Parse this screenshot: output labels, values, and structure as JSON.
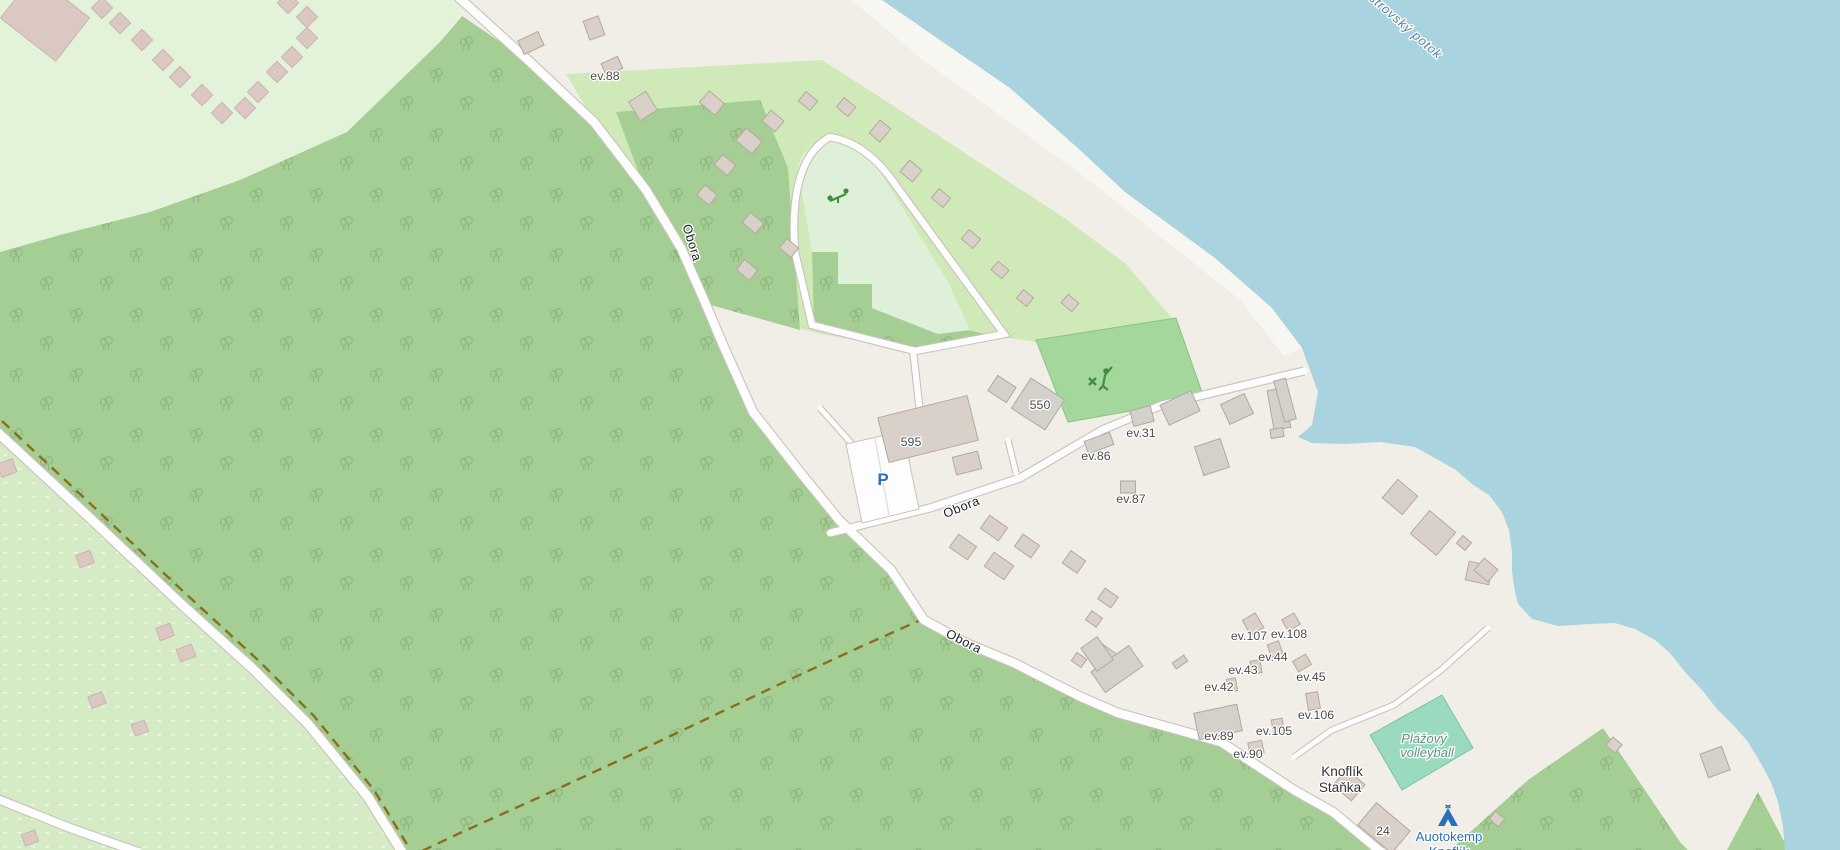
{
  "map": {
    "colors": {
      "base_land": "#f1eee8",
      "sand_bright": "#f8f6f0",
      "water": "#a9d3df",
      "forest": "#a5ce94",
      "scrub": "#e3f3da",
      "orchard": "#d5ebc5",
      "camp_site": "#cfeab8",
      "meadow": "#def1d8",
      "golf_pitch": "#a4d79b",
      "volleyball_pitch": "#9adbc0",
      "building_tan": "#d9d0c9",
      "building_gray": "#d4d0ca",
      "building_pink": "#dcc8c3",
      "road_fill": "#fdfdfd",
      "road_casing": "#c9c3ba",
      "track_dash": "#8c6d1c",
      "icon_green": "#3d8e3d",
      "icon_blue": "#2a6fba"
    },
    "labels": [
      {
        "text": "ev.88",
        "x": 605,
        "y": 80,
        "r": 0,
        "cls": "hn",
        "name": "house-number-ev88"
      },
      {
        "text": "595",
        "x": 911,
        "y": 446,
        "r": 0,
        "cls": "hn",
        "name": "house-number-595"
      },
      {
        "text": "550",
        "x": 1040,
        "y": 409,
        "r": 0,
        "cls": "hn",
        "name": "house-number-550"
      },
      {
        "text": "ev.31",
        "x": 1141,
        "y": 437,
        "r": 0,
        "cls": "hn",
        "name": "house-number-ev31"
      },
      {
        "text": "ev.86",
        "x": 1096,
        "y": 460,
        "r": 0,
        "cls": "hn",
        "name": "house-number-ev86"
      },
      {
        "text": "ev.87",
        "x": 1131,
        "y": 503,
        "r": 0,
        "cls": "hn",
        "name": "house-number-ev87"
      },
      {
        "text": "ev.107",
        "x": 1249,
        "y": 640,
        "r": 0,
        "cls": "hn",
        "name": "house-number-ev107"
      },
      {
        "text": "ev.108",
        "x": 1289,
        "y": 638,
        "r": 0,
        "cls": "hn",
        "name": "house-number-ev108"
      },
      {
        "text": "ev.44",
        "x": 1273,
        "y": 661,
        "r": 0,
        "cls": "hn",
        "name": "house-number-ev44"
      },
      {
        "text": "ev.43",
        "x": 1243,
        "y": 674,
        "r": 0,
        "cls": "hn",
        "name": "house-number-ev43"
      },
      {
        "text": "ev.42",
        "x": 1219,
        "y": 691,
        "r": 0,
        "cls": "hn",
        "name": "house-number-ev42"
      },
      {
        "text": "ev.45",
        "x": 1311,
        "y": 681,
        "r": 0,
        "cls": "hn",
        "name": "house-number-ev45"
      },
      {
        "text": "ev.106",
        "x": 1316,
        "y": 719,
        "r": 0,
        "cls": "hn",
        "name": "house-number-ev106"
      },
      {
        "text": "ev.105",
        "x": 1274,
        "y": 735,
        "r": 0,
        "cls": "hn",
        "name": "house-number-ev105"
      },
      {
        "text": "ev.89",
        "x": 1219,
        "y": 740,
        "r": 0,
        "cls": "hn",
        "name": "house-number-ev89"
      },
      {
        "text": "ev.90",
        "x": 1248,
        "y": 758,
        "r": 0,
        "cls": "hn",
        "name": "house-number-ev90"
      },
      {
        "text": "24",
        "x": 1383,
        "y": 835,
        "r": 0,
        "cls": "hn",
        "name": "house-number-24"
      },
      {
        "text": "Knoflík",
        "x": 1342,
        "y": 776,
        "r": 0,
        "cls": "nm",
        "name": "place-label-knoflik"
      },
      {
        "text": "Staňka",
        "x": 1340,
        "y": 792,
        "r": 0,
        "cls": "nm",
        "name": "place-label-stanka"
      },
      {
        "text": "Plážový",
        "x": 1424,
        "y": 743,
        "r": 0,
        "cls": "pitchlbl",
        "name": "pitch-label-line1"
      },
      {
        "text": "volleyball",
        "x": 1427,
        "y": 757,
        "r": 0,
        "cls": "pitchlbl",
        "name": "pitch-label-line2"
      },
      {
        "text": "Auotokemp",
        "x": 1449,
        "y": 841,
        "r": 0,
        "cls": "camp",
        "name": "campsite-label-line1"
      },
      {
        "text": "Knoflík",
        "x": 1449,
        "y": 856,
        "r": 0,
        "cls": "camp",
        "name": "campsite-label-line2"
      },
      {
        "text": "Obora",
        "x": 688,
        "y": 244,
        "r": 73,
        "cls": "street",
        "name": "street-label-obora-1"
      },
      {
        "text": "Obora",
        "x": 963,
        "y": 511,
        "r": -22,
        "cls": "street",
        "name": "street-label-obora-2"
      },
      {
        "text": "Obora",
        "x": 962,
        "y": 645,
        "r": 27,
        "cls": "street",
        "name": "street-label-obora-3"
      },
      {
        "text": "Ostrovský potok",
        "x": 1399,
        "y": 26,
        "r": 41,
        "cls": "wt",
        "name": "stream-label-ostrovsky-potok"
      },
      {
        "text": "P",
        "x": 883,
        "y": 485,
        "r": 0,
        "cls": "pk",
        "name": "parking-icon"
      }
    ],
    "icons": [
      {
        "kind": "playground",
        "x": 838,
        "y": 197,
        "name": "playground-icon"
      },
      {
        "kind": "golf",
        "x": 1100,
        "y": 380,
        "name": "golf-course-icon"
      },
      {
        "kind": "tent",
        "x": 1448,
        "y": 817,
        "name": "campsite-tent-icon"
      }
    ],
    "buildings": [
      [
        102,
        8,
        15,
        15,
        45,
        "p"
      ],
      [
        120,
        23,
        15,
        15,
        45,
        "p"
      ],
      [
        142,
        40,
        15,
        15,
        45,
        "p"
      ],
      [
        163,
        60,
        15,
        15,
        45,
        "p"
      ],
      [
        180,
        77,
        15,
        15,
        45,
        "p"
      ],
      [
        202,
        95,
        15,
        15,
        45,
        "p"
      ],
      [
        222,
        113,
        15,
        15,
        45,
        "p"
      ],
      [
        245,
        108,
        15,
        15,
        45,
        "p"
      ],
      [
        258,
        92,
        15,
        15,
        45,
        "p"
      ],
      [
        277,
        72,
        15,
        15,
        45,
        "p"
      ],
      [
        292,
        57,
        15,
        15,
        45,
        "p"
      ],
      [
        307,
        38,
        15,
        15,
        45,
        "p"
      ],
      [
        307,
        17,
        15,
        15,
        45,
        "p"
      ],
      [
        288,
        3,
        15,
        15,
        45,
        "p"
      ],
      [
        45,
        18,
        70,
        55,
        38,
        "p"
      ],
      [
        594,
        28,
        16,
        20,
        -20,
        "t"
      ],
      [
        531,
        43,
        22,
        15,
        -25,
        "t"
      ],
      [
        612,
        66,
        18,
        13,
        -25,
        "t"
      ],
      [
        643,
        106,
        20,
        22,
        -32,
        "t"
      ],
      [
        712,
        103,
        20,
        15,
        40,
        "t"
      ],
      [
        749,
        141,
        21,
        16,
        40,
        "t"
      ],
      [
        773,
        121,
        17,
        14,
        40,
        "t"
      ],
      [
        725,
        165,
        17,
        13,
        40,
        "t"
      ],
      [
        707,
        195,
        16,
        13,
        40,
        "t"
      ],
      [
        753,
        223,
        17,
        13,
        40,
        "t"
      ],
      [
        789,
        248,
        15,
        12,
        40,
        "t"
      ],
      [
        747,
        270,
        17,
        13,
        40,
        "t"
      ],
      [
        808,
        101,
        15,
        12,
        40,
        "t"
      ],
      [
        846,
        107,
        15,
        12,
        40,
        "t"
      ],
      [
        880,
        131,
        14,
        17,
        40,
        "t"
      ],
      [
        911,
        171,
        16,
        15,
        40,
        "t"
      ],
      [
        941,
        198,
        15,
        12,
        40,
        "t"
      ],
      [
        971,
        239,
        15,
        12,
        40,
        "t"
      ],
      [
        1000,
        270,
        14,
        11,
        40,
        "t"
      ],
      [
        1025,
        298,
        13,
        11,
        40,
        "t"
      ],
      [
        1070,
        303,
        14,
        11,
        40,
        "t"
      ],
      [
        928,
        429,
        92,
        46,
        -14,
        "t"
      ],
      [
        967,
        463,
        26,
        18,
        -14,
        "t"
      ],
      [
        1002,
        389,
        22,
        18,
        33,
        "g"
      ],
      [
        1038,
        404,
        40,
        36,
        33,
        "g"
      ],
      [
        1180,
        408,
        34,
        22,
        -25,
        "g"
      ],
      [
        1237,
        409,
        26,
        22,
        -25,
        "g"
      ],
      [
        1279,
        409,
        17,
        40,
        -10,
        "g"
      ],
      [
        1277,
        433,
        13,
        9,
        -10,
        "g"
      ],
      [
        1212,
        457,
        27,
        30,
        -18,
        "g"
      ],
      [
        1142,
        416,
        21,
        16,
        -15,
        "g"
      ],
      [
        1099,
        443,
        27,
        13,
        -20,
        "g"
      ],
      [
        1128,
        487,
        15,
        12,
        0,
        "g"
      ],
      [
        1285,
        400,
        12,
        42,
        -15,
        "g"
      ],
      [
        1400,
        497,
        26,
        24,
        40,
        "t"
      ],
      [
        1433,
        533,
        34,
        30,
        40,
        "t"
      ],
      [
        1464,
        543,
        11,
        10,
        40,
        "t"
      ],
      [
        1479,
        573,
        24,
        19,
        12,
        "t"
      ],
      [
        963,
        547,
        22,
        16,
        35,
        "t"
      ],
      [
        994,
        528,
        22,
        16,
        35,
        "t"
      ],
      [
        999,
        566,
        24,
        17,
        35,
        "t"
      ],
      [
        1027,
        546,
        20,
        15,
        35,
        "t"
      ],
      [
        1074,
        562,
        18,
        15,
        35,
        "t"
      ],
      [
        1108,
        598,
        16,
        13,
        35,
        "t"
      ],
      [
        1094,
        619,
        13,
        11,
        35,
        "t"
      ],
      [
        1079,
        660,
        12,
        10,
        35,
        "t"
      ],
      [
        1106,
        657,
        22,
        17,
        35,
        "t"
      ],
      [
        1117,
        669,
        46,
        25,
        -35,
        "g"
      ],
      [
        1097,
        654,
        20,
        28,
        -35,
        "g"
      ],
      [
        1180,
        662,
        14,
        7,
        -35,
        "g"
      ],
      [
        1253,
        624,
        15,
        17,
        -30,
        "t"
      ],
      [
        1291,
        622,
        14,
        13,
        -30,
        "t"
      ],
      [
        1275,
        649,
        12,
        13,
        -20,
        "t"
      ],
      [
        1256,
        667,
        10,
        13,
        -10,
        "t"
      ],
      [
        1232,
        685,
        9,
        13,
        -10,
        "t"
      ],
      [
        1302,
        663,
        15,
        12,
        -30,
        "t"
      ],
      [
        1313,
        701,
        12,
        17,
        -10,
        "t"
      ],
      [
        1278,
        727,
        11,
        16,
        -10,
        "t"
      ],
      [
        1218,
        722,
        44,
        27,
        -12,
        "g"
      ],
      [
        1256,
        748,
        14,
        13,
        -12,
        "t"
      ],
      [
        1349,
        785,
        24,
        21,
        40,
        "t"
      ],
      [
        1384,
        828,
        44,
        29,
        40,
        "t"
      ],
      [
        1497,
        819,
        12,
        10,
        40,
        "t"
      ],
      [
        1614,
        745,
        12,
        11,
        40,
        "t"
      ],
      [
        1715,
        762,
        23,
        25,
        -20,
        "g"
      ],
      [
        1486,
        570,
        18,
        16,
        40,
        "t"
      ],
      [
        7,
        468,
        16,
        14,
        -20,
        "p"
      ],
      [
        85,
        559,
        15,
        13,
        -20,
        "p"
      ],
      [
        165,
        632,
        15,
        13,
        -20,
        "p"
      ],
      [
        186,
        653,
        16,
        13,
        -20,
        "p"
      ],
      [
        97,
        700,
        15,
        12,
        -20,
        "p"
      ],
      [
        140,
        728,
        14,
        12,
        -20,
        "p"
      ],
      [
        30,
        838,
        14,
        12,
        -20,
        "p"
      ]
    ]
  }
}
